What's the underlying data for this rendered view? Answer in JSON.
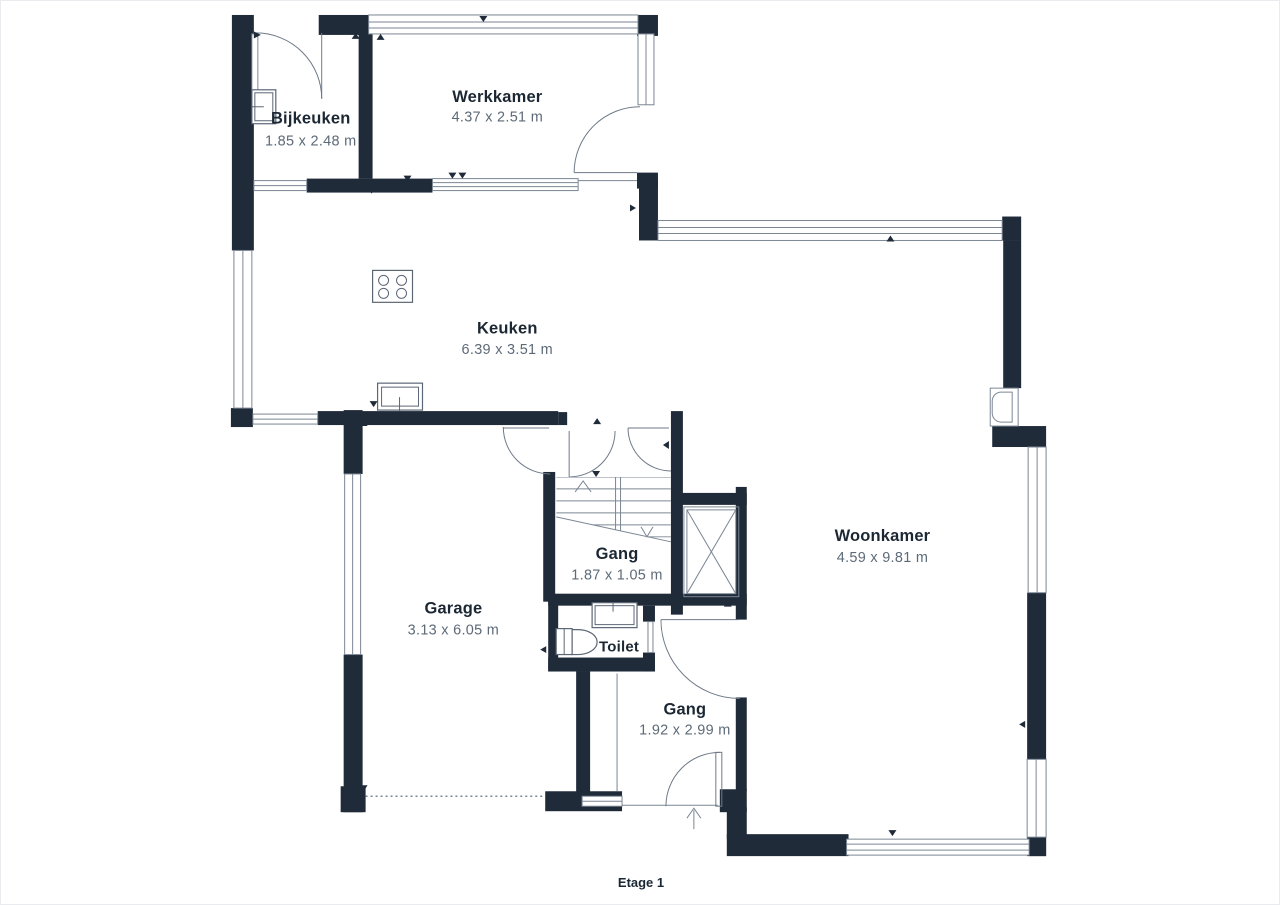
{
  "plan": {
    "floor_label": "Etage 1",
    "rooms": {
      "bijkeuken": {
        "name": "Bijkeuken",
        "dimensions": "1.85 x 2.48 m"
      },
      "werkkamer": {
        "name": "Werkkamer",
        "dimensions": "4.37 x 2.51 m"
      },
      "keuken": {
        "name": "Keuken",
        "dimensions": "6.39 x 3.51 m"
      },
      "gang_boven": {
        "name": "Gang",
        "dimensions": "1.87 x 1.05 m"
      },
      "garage": {
        "name": "Garage",
        "dimensions": "3.13 x 6.05 m"
      },
      "toilet": {
        "name": "Toilet"
      },
      "gang_entree": {
        "name": "Gang",
        "dimensions": "1.92 x 2.99 m"
      },
      "woonkamer": {
        "name": "Woonkamer",
        "dimensions": "4.59 x 9.81 m"
      }
    },
    "colors": {
      "wall": "#202b3a",
      "thin_line": "#7b8694",
      "room_name_text": "#1c2734",
      "dimension_text": "#5d6a78",
      "background": "#ffffff"
    }
  }
}
